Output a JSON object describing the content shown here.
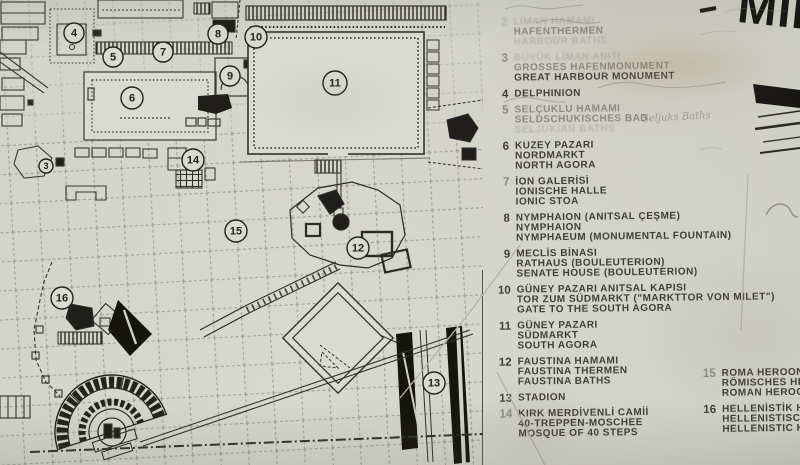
{
  "sign": {
    "title_partial": "MİL",
    "colors": {
      "paper": "#d6d7cf",
      "ink": "#33312c",
      "black": "#1c1b18"
    }
  },
  "graffiti": {
    "bath_note": "Seljuks Baths"
  },
  "legend": {
    "columns": [
      {
        "items": [
          {
            "num": "2",
            "num_fade": 2,
            "lines": [
              {
                "text": "LİMAN HAMAMI",
                "fade": 2
              },
              {
                "text": "HAFENTHERMEN",
                "fade": 1
              },
              {
                "text": "HARBOUR BATHS",
                "fade": 2
              }
            ]
          },
          {
            "num": "3",
            "num_fade": 1,
            "lines": [
              {
                "text": "BÜYÜK LİMAN ANITI",
                "fade": 2
              },
              {
                "text": "GROSSES HAFENMONUMENT",
                "fade": 1
              },
              {
                "text": "GREAT HARBOUR MONUMENT",
                "fade": 0
              }
            ]
          },
          {
            "num": "4",
            "num_fade": 0,
            "lines": [
              {
                "text": "DELPHINION",
                "fade": 0
              }
            ]
          },
          {
            "num": "5",
            "num_fade": 1,
            "lines": [
              {
                "text": "SELÇUKLU HAMAMI",
                "fade": 1
              },
              {
                "text": "SELDSCHUKISCHES BAD",
                "fade": 1
              },
              {
                "text": "SELJUKIAN BATHS",
                "fade": 2
              }
            ]
          },
          {
            "num": "6",
            "num_fade": 0,
            "lines": [
              {
                "text": "KUZEY PAZARI",
                "fade": 0
              },
              {
                "text": "NORDMARKT",
                "fade": 0
              },
              {
                "text": "NORTH AGORA",
                "fade": 0
              }
            ]
          },
          {
            "num": "7",
            "num_fade": 1,
            "lines": [
              {
                "text": "İON GALERİSİ",
                "fade": 0
              },
              {
                "text": "IONISCHE HALLE",
                "fade": 0
              },
              {
                "text": "IONIC STOA",
                "fade": 0
              }
            ]
          },
          {
            "num": "8",
            "num_fade": 0,
            "lines": [
              {
                "text": "NYMPHAION (ANITSAL ÇEŞME)",
                "fade": 0
              },
              {
                "text": "NYMPHAION",
                "fade": 0
              },
              {
                "text": "NYMPHAEUM (MONUMENTAL FOUNTAIN)",
                "fade": 0
              }
            ]
          },
          {
            "num": "9",
            "num_fade": 0,
            "lines": [
              {
                "text": "MECLİS BİNASI",
                "fade": 0
              },
              {
                "text": "RATHAUS (BOULEUTERION)",
                "fade": 0
              },
              {
                "text": "SENATE HOUSE (BOULEUTERION)",
                "fade": 0
              }
            ]
          },
          {
            "num": "10",
            "num_fade": 0,
            "lines": [
              {
                "text": "GÜNEY PAZARI ANITSAL KAPISI",
                "fade": 0
              },
              {
                "text": "TOR ZUM SÜDMARKT (\"MARKTTOR VON MILET\")",
                "fade": 0
              },
              {
                "text": "GATE TO THE SOUTH AGORA",
                "fade": 0
              }
            ]
          },
          {
            "num": "11",
            "num_fade": 0,
            "lines": [
              {
                "text": "GÜNEY PAZARI",
                "fade": 0
              },
              {
                "text": "SÜDMARKT",
                "fade": 0
              },
              {
                "text": "SOUTH AGORA",
                "fade": 0
              }
            ]
          },
          {
            "num": "12",
            "num_fade": 0,
            "lines": [
              {
                "text": "FAUSTINA HAMAMI",
                "fade": 0
              },
              {
                "text": "FAUSTINA THERMEN",
                "fade": 0
              },
              {
                "text": "FAUSTINA BATHS",
                "fade": 0
              }
            ]
          },
          {
            "num": "13",
            "num_fade": 0,
            "lines": [
              {
                "text": "STADION",
                "fade": 0
              }
            ]
          },
          {
            "num": "14",
            "num_fade": 1,
            "lines": [
              {
                "text": "KIRK MERDİVENLİ CAMİİ",
                "fade": 0
              },
              {
                "text": "40-TREPPEN-MOSCHEE",
                "fade": 0
              },
              {
                "text": "MOSQUE OF 40 STEPS",
                "fade": 0
              }
            ]
          }
        ]
      },
      {
        "items": [
          {
            "num": "15",
            "num_fade": 1,
            "lines": [
              {
                "text": "ROMA HEROONU",
                "fade": 0
              },
              {
                "text": "RÖMISCHES HEROON",
                "fade": 0
              },
              {
                "text": "ROMAN HEROON",
                "fade": 0
              }
            ]
          },
          {
            "num": "16",
            "num_fade": 0,
            "lines": [
              {
                "text": "HELLENİSTİK HEROON",
                "fade": 0
              },
              {
                "text": "HELLENISTISCHES HEROON",
                "fade": 0
              },
              {
                "text": "HELLENISTIC HEROON",
                "fade": 0
              }
            ]
          }
        ]
      }
    ]
  },
  "map": {
    "markers": [
      {
        "n": "3",
        "x": 46,
        "y": 166,
        "r": 7
      },
      {
        "n": "4",
        "x": 74,
        "y": 33,
        "r": 10
      },
      {
        "n": "5",
        "x": 113,
        "y": 57,
        "r": 10
      },
      {
        "n": "6",
        "x": 132,
        "y": 98,
        "r": 11
      },
      {
        "n": "7",
        "x": 163,
        "y": 52,
        "r": 10
      },
      {
        "n": "8",
        "x": 218,
        "y": 34,
        "r": 10
      },
      {
        "n": "9",
        "x": 230,
        "y": 76,
        "r": 10
      },
      {
        "n": "10",
        "x": 256,
        "y": 37,
        "r": 11
      },
      {
        "n": "11",
        "x": 335,
        "y": 83,
        "r": 12
      },
      {
        "n": "12",
        "x": 358,
        "y": 248,
        "r": 11
      },
      {
        "n": "13",
        "x": 434,
        "y": 383,
        "r": 11
      },
      {
        "n": "14",
        "x": 193,
        "y": 160,
        "r": 11
      },
      {
        "n": "15",
        "x": 236,
        "y": 231,
        "r": 11
      },
      {
        "n": "16",
        "x": 62,
        "y": 298,
        "r": 11
      }
    ]
  }
}
